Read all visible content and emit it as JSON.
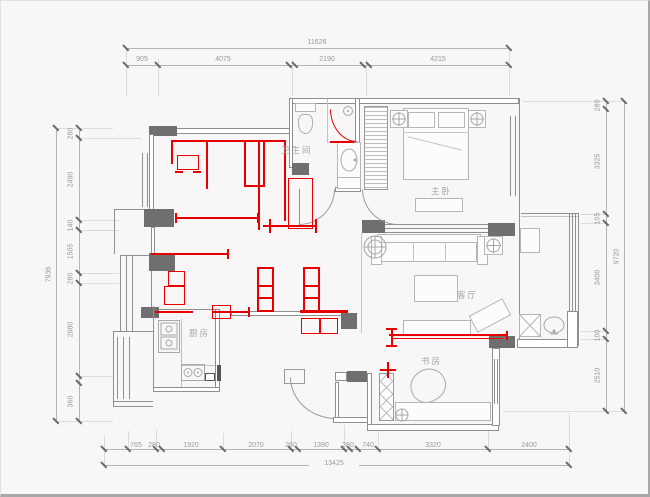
{
  "rooms": {
    "bathroom": "卫生间",
    "master_bedroom": "主卧",
    "living_room": "客厅",
    "kitchen": "厨房",
    "study": "书房"
  },
  "dimensions": {
    "top": {
      "total": "11626",
      "segments": [
        "905",
        "4075",
        "2190",
        "4215"
      ]
    },
    "bottom": {
      "total": "13425",
      "segments": [
        "765",
        "280",
        "1920",
        "2070",
        "260",
        "1390",
        "280",
        "740",
        "3320",
        "2400"
      ]
    },
    "left": {
      "total": "7936",
      "segments": [
        "280",
        "2490",
        "140",
        "1505",
        "280",
        "2980",
        "360"
      ]
    },
    "right": {
      "total": "9720",
      "segments": [
        "280",
        "3325",
        "105",
        "3400",
        "100",
        "2510"
      ]
    }
  },
  "colors": {
    "background": "#f8f6f6",
    "wall_line": "#8f8f8f",
    "column_fill": "#6f6f6f",
    "furniture_line": "#b6b6b6",
    "dimension_text": "#9a9a9a",
    "markup_red": "#e80000"
  }
}
